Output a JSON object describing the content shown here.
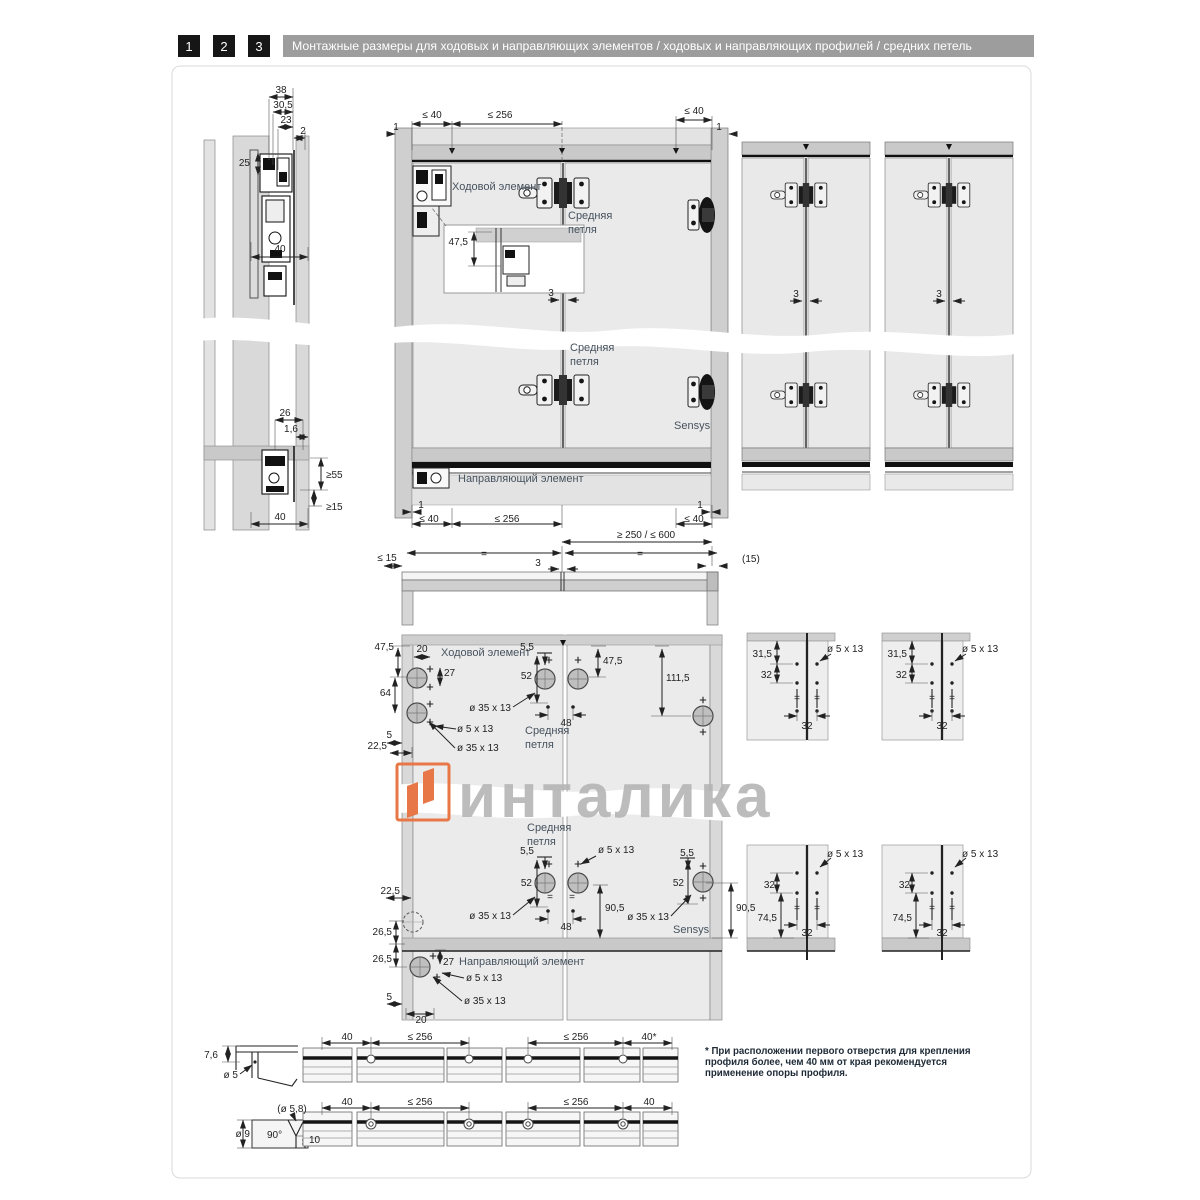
{
  "header": {
    "steps": [
      "1",
      "2",
      "3"
    ],
    "title": "Монтажные размеры для ходовых и направляющих элементов / ходовых и направляющих профилей / средних петель"
  },
  "watermark": {
    "brand": "инталика",
    "logo_color": "#e87747",
    "text_color": "#b3b3b3"
  },
  "footnote": {
    "lines": [
      "* При расположении первого отверстия для крепления",
      "профиля более, чем 40 мм от края рекомендуется",
      "применение опоры профиля."
    ]
  },
  "colors": {
    "header_bar": "#9d9d9d",
    "step_square": "#161616",
    "accent_orange": "#e87747"
  },
  "texts": [
    {
      "t": "38",
      "x": 281,
      "y": 93
    },
    {
      "t": "30,5",
      "x": 283,
      "y": 108
    },
    {
      "t": "23",
      "x": 286,
      "y": 123
    },
    {
      "t": "2",
      "x": 303,
      "y": 134
    },
    {
      "t": "25",
      "x": 250,
      "y": 166,
      "a": "e"
    },
    {
      "t": "40",
      "x": 280,
      "y": 252
    },
    {
      "t": "26",
      "x": 285,
      "y": 416
    },
    {
      "t": "1,6",
      "x": 291,
      "y": 432
    },
    {
      "t": "≥55",
      "x": 326,
      "y": 478,
      "a": "s"
    },
    {
      "t": "≥15",
      "x": 326,
      "y": 510,
      "a": "s"
    },
    {
      "t": "40",
      "x": 280,
      "y": 520
    },
    {
      "t": "1",
      "x": 396,
      "y": 130
    },
    {
      "t": "≤ 40",
      "x": 432,
      "y": 118
    },
    {
      "t": "≤ 256",
      "x": 500,
      "y": 118
    },
    {
      "t": "≤ 40",
      "x": 694,
      "y": 114
    },
    {
      "t": "1",
      "x": 719,
      "y": 130
    },
    {
      "t": "Ходовой элемент",
      "x": 452,
      "y": 190,
      "a": "s",
      "c": "label"
    },
    {
      "t": "Средняя",
      "x": 568,
      "y": 219,
      "a": "s",
      "c": "label"
    },
    {
      "t": "петля",
      "x": 568,
      "y": 233,
      "a": "s",
      "c": "label"
    },
    {
      "t": "47,5",
      "x": 468,
      "y": 245,
      "a": "e"
    },
    {
      "t": "3",
      "x": 551,
      "y": 296
    },
    {
      "t": "Средняя",
      "x": 570,
      "y": 351,
      "a": "s",
      "c": "label"
    },
    {
      "t": "петля",
      "x": 570,
      "y": 365,
      "a": "s",
      "c": "label"
    },
    {
      "t": "Sensys",
      "x": 674,
      "y": 429,
      "a": "s",
      "c": "label"
    },
    {
      "t": "Направляющий элемент",
      "x": 458,
      "y": 482,
      "a": "s",
      "c": "label"
    },
    {
      "t": "1",
      "x": 421,
      "y": 508
    },
    {
      "t": "≤ 40",
      "x": 429,
      "y": 522
    },
    {
      "t": "≤ 256",
      "x": 507,
      "y": 522
    },
    {
      "t": "1",
      "x": 700,
      "y": 508
    },
    {
      "t": "≤ 40",
      "x": 694,
      "y": 522
    },
    {
      "t": "3",
      "x": 796,
      "y": 297
    },
    {
      "t": "3",
      "x": 939,
      "y": 297
    },
    {
      "t": "≥ 250 / ≤ 600",
      "x": 646,
      "y": 538
    },
    {
      "t": "≤ 15",
      "x": 387,
      "y": 561
    },
    {
      "t": "=",
      "x": 484,
      "y": 557
    },
    {
      "t": "=",
      "x": 640,
      "y": 557
    },
    {
      "t": "3",
      "x": 538,
      "y": 566
    },
    {
      "t": "(15)",
      "x": 742,
      "y": 562,
      "a": "s"
    },
    {
      "t": "47,5",
      "x": 394,
      "y": 650,
      "a": "e"
    },
    {
      "t": "20",
      "x": 422,
      "y": 652
    },
    {
      "t": "Ходовой элемент",
      "x": 441,
      "y": 656,
      "a": "s",
      "c": "label"
    },
    {
      "t": "27",
      "x": 444,
      "y": 676,
      "a": "s"
    },
    {
      "t": "64",
      "x": 391,
      "y": 696,
      "a": "e"
    },
    {
      "t": "ø 5 x 13",
      "x": 457,
      "y": 732,
      "a": "s"
    },
    {
      "t": "5",
      "x": 392,
      "y": 738,
      "a": "e"
    },
    {
      "t": "22,5",
      "x": 387,
      "y": 749,
      "a": "e"
    },
    {
      "t": "ø 35 x 13",
      "x": 457,
      "y": 751,
      "a": "s"
    },
    {
      "t": "5,5",
      "x": 534,
      "y": 650,
      "a": "e"
    },
    {
      "t": "52",
      "x": 532,
      "y": 679,
      "a": "e"
    },
    {
      "t": "ø 35 x 13",
      "x": 511,
      "y": 711,
      "a": "e"
    },
    {
      "t": "48",
      "x": 566,
      "y": 726
    },
    {
      "t": "Средняя",
      "x": 525,
      "y": 734,
      "a": "s",
      "c": "label"
    },
    {
      "t": "петля",
      "x": 525,
      "y": 748,
      "a": "s",
      "c": "label"
    },
    {
      "t": "47,5",
      "x": 603,
      "y": 664,
      "a": "s"
    },
    {
      "t": "111,5",
      "x": 666,
      "y": 681,
      "a": "s"
    },
    {
      "t": "31,5",
      "x": 772,
      "y": 657,
      "a": "e"
    },
    {
      "t": "32",
      "x": 772,
      "y": 678,
      "a": "e"
    },
    {
      "t": "ø 5 x 13",
      "x": 827,
      "y": 652,
      "a": "s"
    },
    {
      "t": "=",
      "x": 797,
      "y": 701
    },
    {
      "t": "=",
      "x": 817,
      "y": 701
    },
    {
      "t": "32",
      "x": 807,
      "y": 729
    },
    {
      "t": "31,5",
      "x": 907,
      "y": 657,
      "a": "e"
    },
    {
      "t": "32",
      "x": 907,
      "y": 678,
      "a": "e"
    },
    {
      "t": "ø 5 x 13",
      "x": 962,
      "y": 652,
      "a": "s"
    },
    {
      "t": "=",
      "x": 932,
      "y": 701
    },
    {
      "t": "=",
      "x": 952,
      "y": 701
    },
    {
      "t": "32",
      "x": 942,
      "y": 729
    },
    {
      "t": "Средняя",
      "x": 527,
      "y": 831,
      "a": "s",
      "c": "label"
    },
    {
      "t": "петля",
      "x": 527,
      "y": 845,
      "a": "s",
      "c": "label"
    },
    {
      "t": "5,5",
      "x": 534,
      "y": 854,
      "a": "e"
    },
    {
      "t": "ø 5 x 13",
      "x": 598,
      "y": 853,
      "a": "s"
    },
    {
      "t": "52",
      "x": 532,
      "y": 886,
      "a": "e"
    },
    {
      "t": "ø 35 x 13",
      "x": 511,
      "y": 919,
      "a": "e"
    },
    {
      "t": "48",
      "x": 566,
      "y": 930
    },
    {
      "t": "90,5",
      "x": 605,
      "y": 911,
      "a": "s"
    },
    {
      "t": "=",
      "x": 550,
      "y": 900
    },
    {
      "t": "=",
      "x": 572,
      "y": 900
    },
    {
      "t": "5,5",
      "x": 694,
      "y": 856,
      "a": "e"
    },
    {
      "t": "52",
      "x": 684,
      "y": 886,
      "a": "e"
    },
    {
      "t": "ø 35 x 13",
      "x": 669,
      "y": 920,
      "a": "e"
    },
    {
      "t": "Sensys",
      "x": 673,
      "y": 933,
      "a": "s",
      "c": "label"
    },
    {
      "t": "90,5",
      "x": 736,
      "y": 911,
      "a": "s"
    },
    {
      "t": "22,5",
      "x": 400,
      "y": 894,
      "a": "e"
    },
    {
      "t": "26,5",
      "x": 392,
      "y": 935,
      "a": "e"
    },
    {
      "t": "26,5",
      "x": 392,
      "y": 962,
      "a": "e"
    },
    {
      "t": "27",
      "x": 443,
      "y": 965,
      "a": "s"
    },
    {
      "t": "Направляющий элемент",
      "x": 459,
      "y": 965,
      "a": "s",
      "c": "label"
    },
    {
      "t": "ø 5 x 13",
      "x": 466,
      "y": 981,
      "a": "s"
    },
    {
      "t": "ø 35 x 13",
      "x": 464,
      "y": 1004,
      "a": "s"
    },
    {
      "t": "5",
      "x": 392,
      "y": 1000,
      "a": "e"
    },
    {
      "t": "20",
      "x": 421,
      "y": 1023
    },
    {
      "t": "32",
      "x": 775,
      "y": 888,
      "a": "e"
    },
    {
      "t": "74,5",
      "x": 777,
      "y": 921,
      "a": "e"
    },
    {
      "t": "ø 5 x 13",
      "x": 827,
      "y": 857,
      "a": "s"
    },
    {
      "t": "=",
      "x": 797,
      "y": 911
    },
    {
      "t": "=",
      "x": 817,
      "y": 911
    },
    {
      "t": "32",
      "x": 807,
      "y": 936
    },
    {
      "t": "32",
      "x": 910,
      "y": 888,
      "a": "e"
    },
    {
      "t": "74,5",
      "x": 912,
      "y": 921,
      "a": "e"
    },
    {
      "t": "ø 5 x 13",
      "x": 962,
      "y": 857,
      "a": "s"
    },
    {
      "t": "=",
      "x": 932,
      "y": 911
    },
    {
      "t": "=",
      "x": 952,
      "y": 911
    },
    {
      "t": "32",
      "x": 942,
      "y": 936
    },
    {
      "t": "7,6",
      "x": 218,
      "y": 1058,
      "a": "e"
    },
    {
      "t": "ø 5",
      "x": 238,
      "y": 1078,
      "a": "e"
    },
    {
      "t": "(ø 5,8)",
      "x": 292,
      "y": 1112
    },
    {
      "t": "ø 9",
      "x": 250,
      "y": 1137,
      "a": "e"
    },
    {
      "t": "90°",
      "x": 267,
      "y": 1138,
      "a": "s"
    },
    {
      "t": "10",
      "x": 309,
      "y": 1143,
      "a": "s"
    },
    {
      "t": "40",
      "x": 347,
      "y": 1040
    },
    {
      "t": "≤ 256",
      "x": 420,
      "y": 1040
    },
    {
      "t": "≤ 256",
      "x": 576,
      "y": 1040
    },
    {
      "t": "40*",
      "x": 649,
      "y": 1040
    },
    {
      "t": "40",
      "x": 347,
      "y": 1105
    },
    {
      "t": "≤ 256",
      "x": 420,
      "y": 1105
    },
    {
      "t": "≤ 256",
      "x": 576,
      "y": 1105
    },
    {
      "t": "40",
      "x": 649,
      "y": 1105
    }
  ]
}
